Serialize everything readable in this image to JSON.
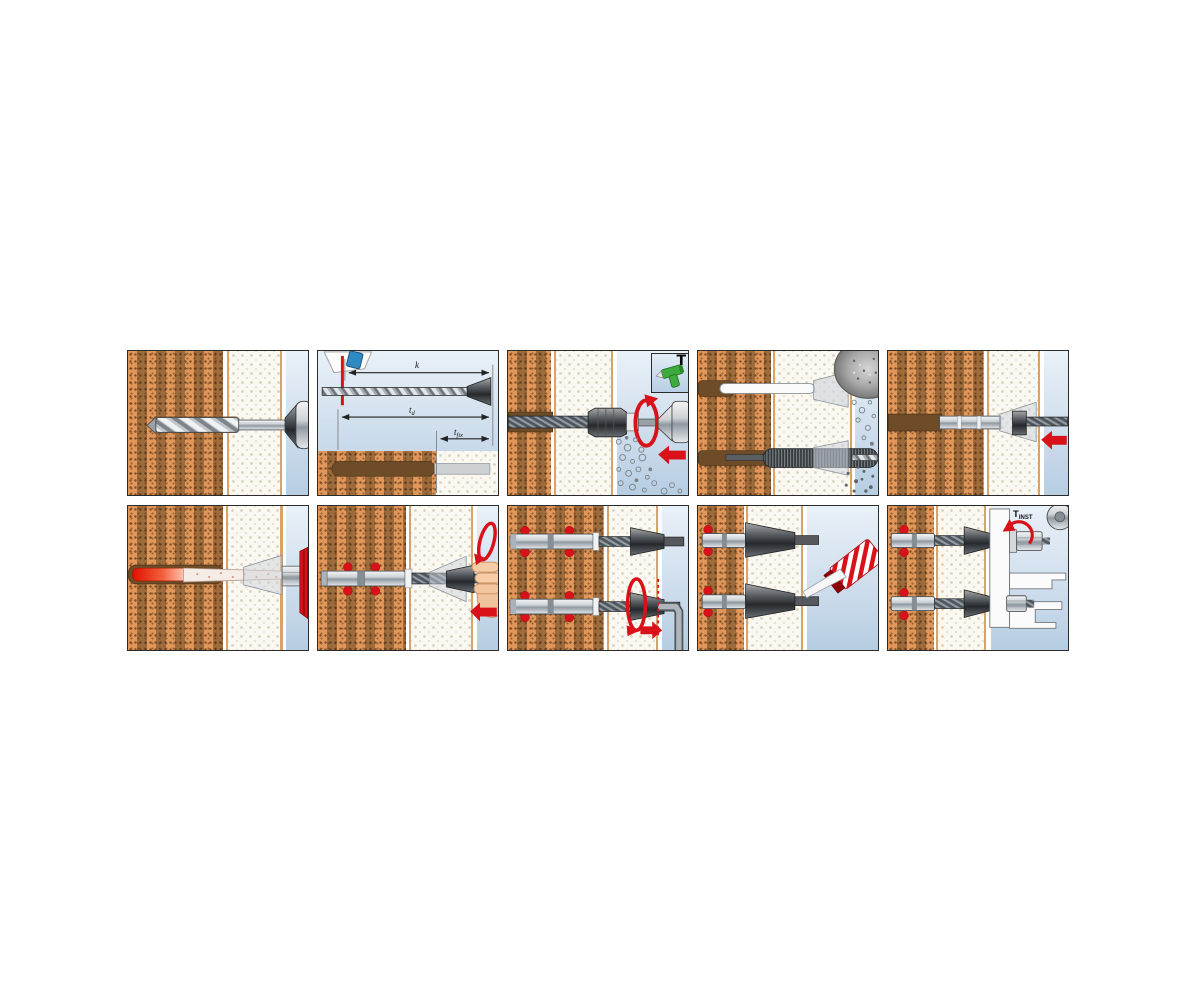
{
  "diagram": {
    "type": "installation-instruction-sequence",
    "grid": {
      "rows": 2,
      "columns": 5
    },
    "labels": {
      "k": "k",
      "embed_depth_main": "t",
      "embed_depth_sub": "d",
      "fixture_thickness_main": "t",
      "fixture_thickness_sub": "fix",
      "install_torque_main": "T",
      "install_torque_sub": "INST"
    },
    "icons": {
      "rotary_mode": "T"
    },
    "colors": {
      "accent_red": "#d9121a",
      "brick_dark": "#9e6c3c",
      "brick_light": "#e1975a",
      "plaster_white": "#faf8f1",
      "air_blue_top": "#e9f1f8",
      "air_blue_bottom": "#b6cde2",
      "hole_brown": "#6e4c28",
      "drill_green": "#3dab3d",
      "depth_gauge_blue": "#2f8ac2"
    },
    "panels": [
      {
        "step": 1,
        "name": "drill-hole"
      },
      {
        "step": 2,
        "name": "set-drilling-depth"
      },
      {
        "step": 3,
        "name": "drive-in-sieve-sleeve"
      },
      {
        "step": 4,
        "name": "clean-hole-blow-and-brush"
      },
      {
        "step": 5,
        "name": "insert-anchor-sleeve"
      },
      {
        "step": 6,
        "name": "inject-mortar"
      },
      {
        "step": 7,
        "name": "insert-anchor-rod"
      },
      {
        "step": 8,
        "name": "set-anchor-hex-key"
      },
      {
        "step": 9,
        "name": "apply-sealant"
      },
      {
        "step": 10,
        "name": "mount-fixture-torque-wrench"
      }
    ]
  }
}
